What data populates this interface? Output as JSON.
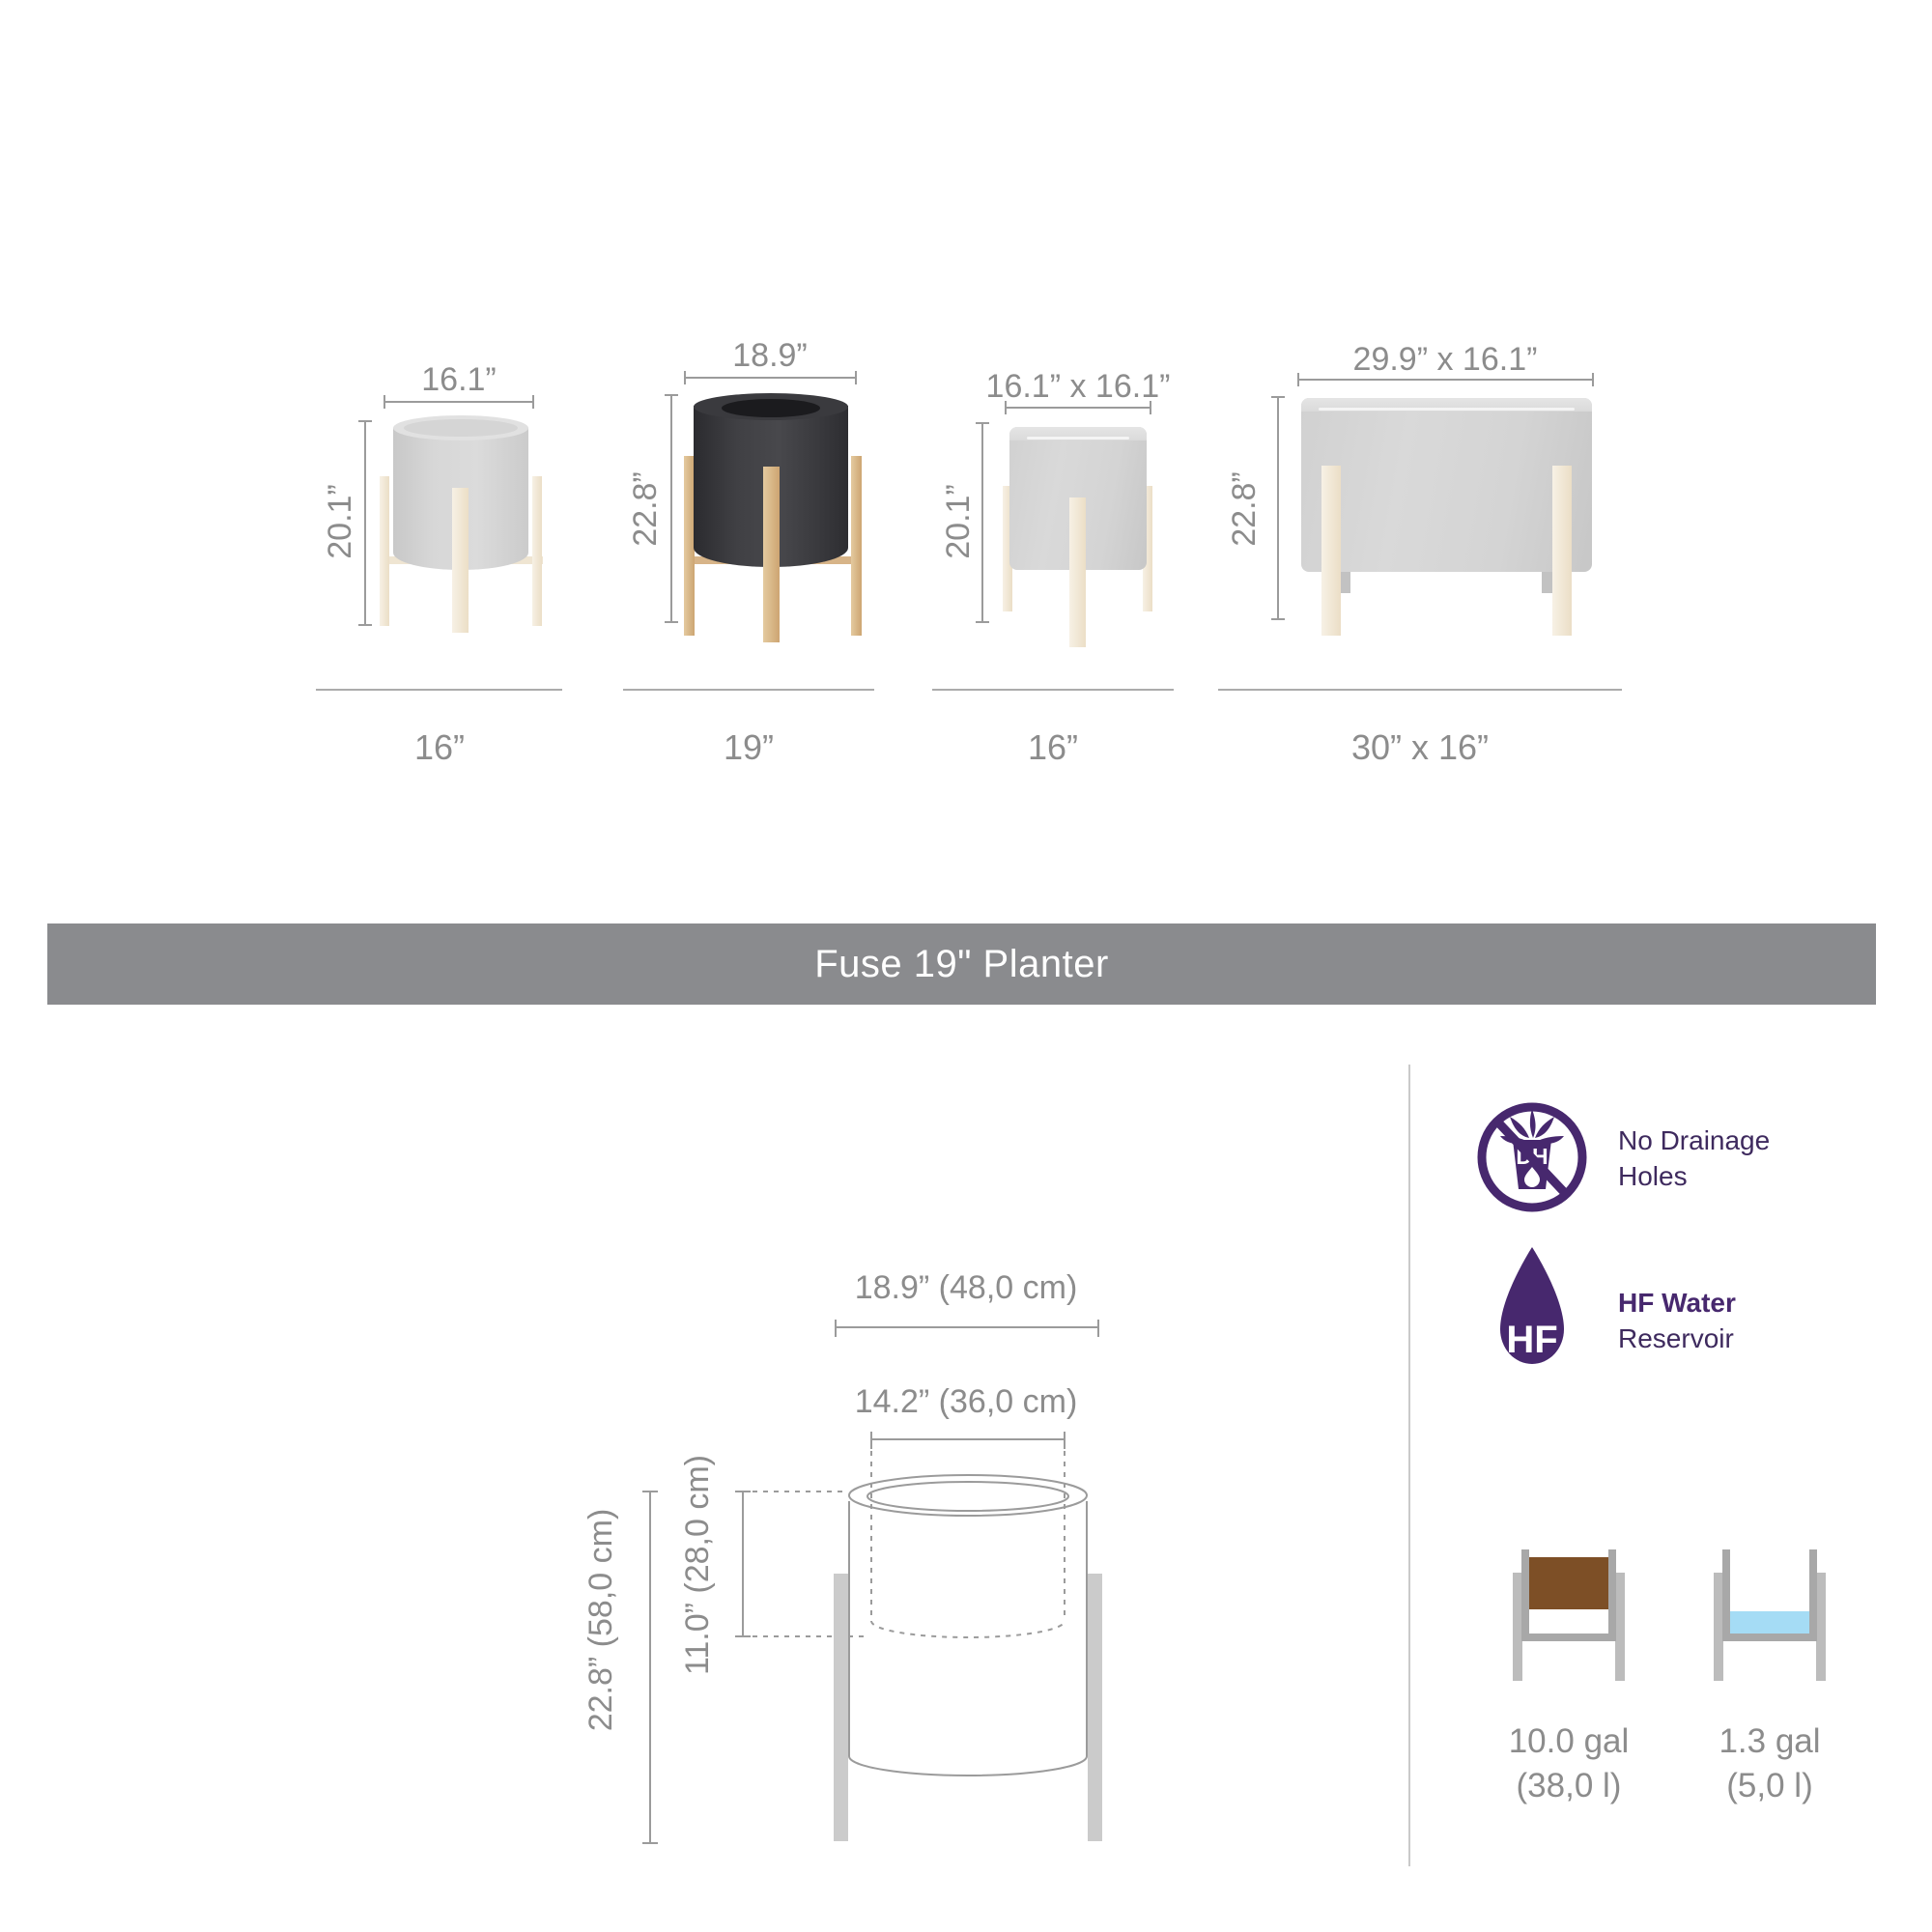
{
  "banner": {
    "title": "Fuse 19\" Planter"
  },
  "size_chart": {
    "variants": [
      {
        "name": "16 inch round planter",
        "width_label": "16.1”",
        "height_label": "20.1”",
        "size_label": "16”",
        "highlighted": false
      },
      {
        "name": "19 inch round planter",
        "width_label": "18.9”",
        "height_label": "22.8”",
        "size_label": "19”",
        "highlighted": true
      },
      {
        "name": "16 inch square planter",
        "width_label": "16.1” x 16.1”",
        "height_label": "20.1”",
        "size_label": "16”",
        "highlighted": false
      },
      {
        "name": "30 x 16 inch planter",
        "width_label": "29.9” x 16.1”",
        "height_label": "22.8”",
        "size_label": "30” x 16”",
        "highlighted": false
      }
    ]
  },
  "tech_drawing": {
    "outer_width": "18.9” (48,0 cm)",
    "liner_width": "14.2” (36,0 cm)",
    "overall_height": "22.8” (58,0 cm)",
    "liner_depth": "11.0” (28,0 cm)"
  },
  "features": [
    {
      "icon_label": "DH",
      "line1": "No Drainage",
      "line2": "Holes"
    },
    {
      "icon_label": "HF",
      "line1": "HF Water",
      "line2": "Reservoir"
    }
  ],
  "capacities": [
    {
      "type": "soil",
      "volume": "10.0 gal",
      "metric": "(38,0 l)"
    },
    {
      "type": "water",
      "volume": "1.3 gal",
      "metric": "(5,0 l)"
    }
  ],
  "colors": {
    "accent_purple": "#47286e",
    "banner_gray": "#8a8b8e",
    "dimension_gray": "#8c8c8c",
    "soil_brown": "#7d4f26",
    "water_blue": "#a5dcf5",
    "wood_tan": "#d8b688",
    "wood_cream": "#f2e9d9"
  }
}
